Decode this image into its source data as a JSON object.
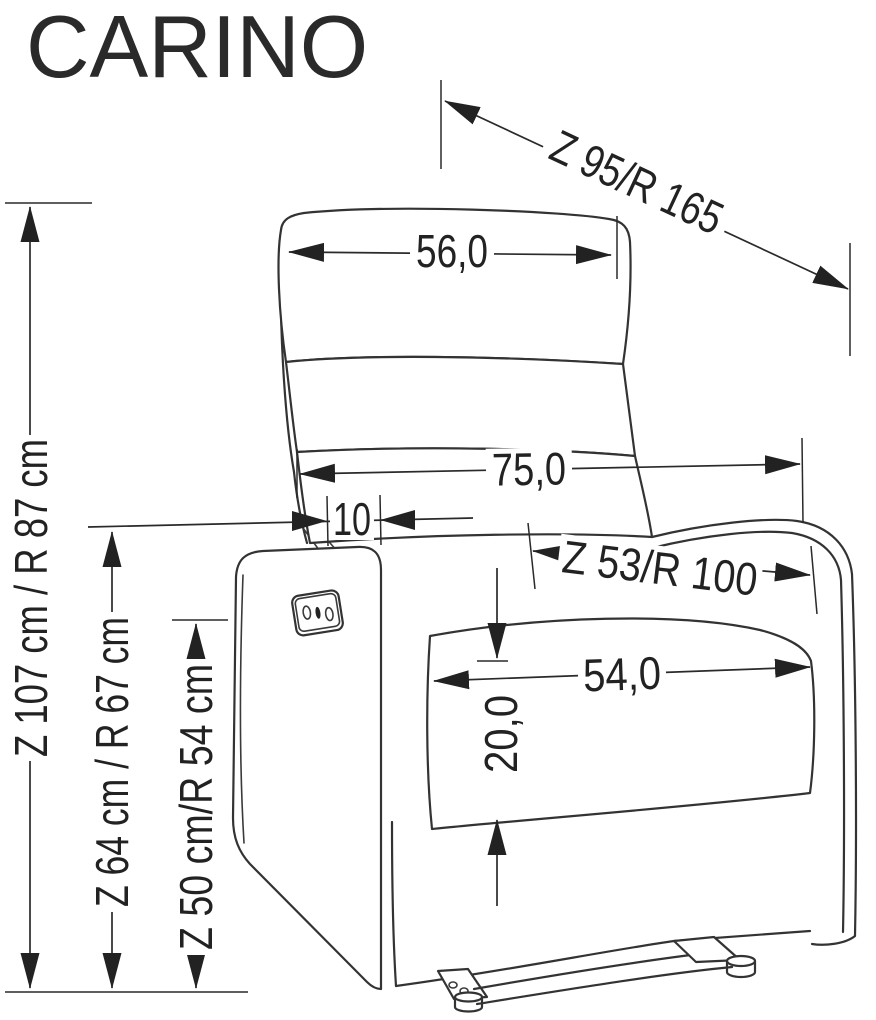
{
  "title": "CARINO",
  "labels": {
    "dim_total_reclined": "Z 95/R 165",
    "dim_headrest_width": "56,0",
    "dim_backrest_width": "75,0",
    "dim_back_offset": "10",
    "dim_seat_diagonal": "Z 53/R 100",
    "dim_seat_width": "54,0",
    "dim_cushion_thickness": "20,0",
    "dim_height_total": "Z 107 cm / R 87 cm",
    "dim_height_armrest": "Z 64 cm / R 67 cm",
    "dim_height_seat": "Z 50 cm/R 54 cm"
  },
  "colors": {
    "line": "#333333",
    "dimension_line": "#2a2a2a",
    "text": "#222222",
    "background": "#ffffff"
  }
}
